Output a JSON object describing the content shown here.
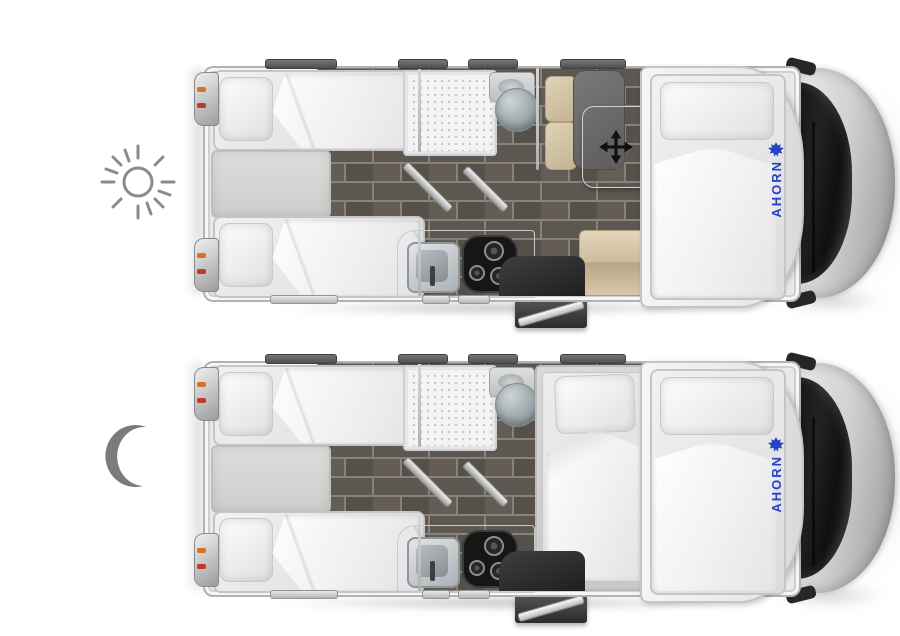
{
  "brand": {
    "name": "AHORN",
    "text_color": "#2543c4",
    "logo_icon": "maple-leaf-icon"
  },
  "views": [
    {
      "id": "day-floorplan",
      "indicator_icon": "sun-icon",
      "brand_label": "AHORN"
    },
    {
      "id": "night-floorplan",
      "indicator_icon": "moon-icon",
      "brand_label": "AHORN"
    }
  ],
  "icons": {
    "sun": "sun-icon",
    "moon": "moon-icon",
    "move_table": "move-arrows-icon",
    "maple_leaf": "maple-leaf-icon"
  },
  "palette": {
    "background": "#ffffff",
    "icon_gray": "#828282",
    "floor_tile": "#5d5751",
    "floor_grout": "#8a8179",
    "mattress": "#e9e9eb",
    "cushion_beige": "#d2c3a6",
    "cushion_dark": "#6b696a",
    "wall_silver": "#b2b2b2",
    "counter_marble": "#f5f4f2",
    "seat_black": "#2e2e2e",
    "cab_glass": "#161616",
    "taillight_orange": "#d4722a",
    "taillight_red": "#c0392b"
  }
}
